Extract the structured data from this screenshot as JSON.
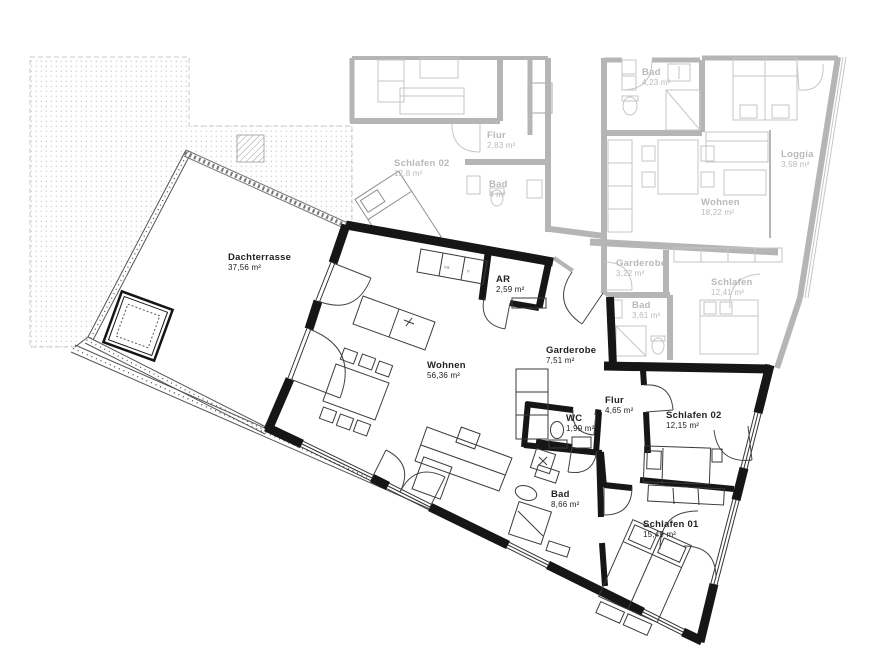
{
  "plan": {
    "type": "apartment-floor-plan",
    "colors": {
      "main_wall": "#161616",
      "neighbor_wall": "#b5b5b5",
      "neighbor_furniture": "#c6c6c6",
      "main_label": "#222222",
      "neighbor_label": "#b9b9b9",
      "stipple_dot": "#c9c9c9"
    },
    "main_rooms": [
      {
        "id": "dachterrasse",
        "name": "Dachterrasse",
        "area": "37,56 m²",
        "x": 228,
        "y": 252
      },
      {
        "id": "wohnen",
        "name": "Wohnen",
        "area": "56,36 m²",
        "x": 427,
        "y": 360
      },
      {
        "id": "ar",
        "name": "AR",
        "area": "2,59 m²",
        "x": 496,
        "y": 274
      },
      {
        "id": "garderobe",
        "name": "Garderobe",
        "area": "7,51 m²",
        "x": 546,
        "y": 345
      },
      {
        "id": "wc",
        "name": "WC",
        "area": "1,99 m²",
        "x": 566,
        "y": 413
      },
      {
        "id": "flur",
        "name": "Flur",
        "area": "4,65 m²",
        "x": 605,
        "y": 395
      },
      {
        "id": "schlafen-02",
        "name": "Schlafen 02",
        "area": "12,15 m²",
        "x": 666,
        "y": 410
      },
      {
        "id": "bad",
        "name": "Bad",
        "area": "8,66 m²",
        "x": 551,
        "y": 489
      },
      {
        "id": "schlafen-01",
        "name": "Schlafen 01",
        "area": "15,49 m²",
        "x": 643,
        "y": 519
      }
    ],
    "neighbor_rooms": [
      {
        "id": "n-schlafen-02",
        "name": "Schlafen 02",
        "area": "12,8 m²",
        "x": 394,
        "y": 158
      },
      {
        "id": "n-flur",
        "name": "Flur",
        "area": "2,83 m²",
        "x": 487,
        "y": 130
      },
      {
        "id": "n-bad-1",
        "name": "Bad",
        "area": "4 m²",
        "x": 489,
        "y": 179
      },
      {
        "id": "n-bad-2",
        "name": "Bad",
        "area": "4,23 m²",
        "x": 642,
        "y": 67
      },
      {
        "id": "n-wohnen",
        "name": "Wohnen",
        "area": "18,22 m²",
        "x": 701,
        "y": 197
      },
      {
        "id": "n-loggia",
        "name": "Loggia",
        "area": "3,58 m²",
        "x": 781,
        "y": 149
      },
      {
        "id": "n-garderobe",
        "name": "Garderobe",
        "area": "3,22 m²",
        "x": 616,
        "y": 258
      },
      {
        "id": "n-bad-3",
        "name": "Bad",
        "area": "3,61 m²",
        "x": 632,
        "y": 300
      },
      {
        "id": "n-schlafen",
        "name": "Schlafen",
        "area": "12,41 m²",
        "x": 711,
        "y": 277
      }
    ],
    "kitchen": {
      "appliance_labels": [
        "ea.",
        "e"
      ]
    }
  }
}
